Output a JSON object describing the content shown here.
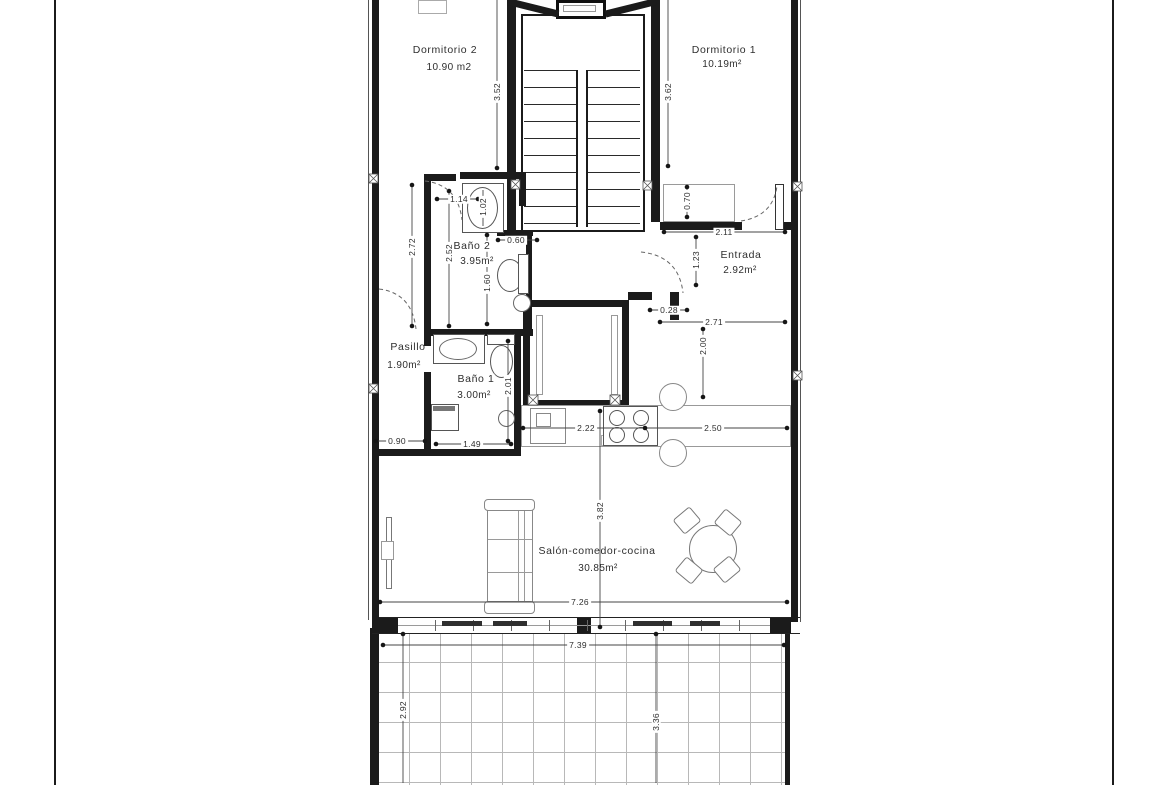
{
  "drawing": {
    "rooms": {
      "dormitorio2": {
        "name": "Dormitorio 2",
        "area": "10.90 m2"
      },
      "dormitorio1": {
        "name": "Dormitorio 1",
        "area": "10.19m²"
      },
      "banyo2": {
        "name": "Baño 2",
        "area": "3.95m²"
      },
      "entrada": {
        "name": "Entrada",
        "area": "2.92m²"
      },
      "pasillo": {
        "name": "Pasillo",
        "area": "1.90m²"
      },
      "banyo1": {
        "name": "Baño 1",
        "area": "3.00m²"
      },
      "salon": {
        "name": "Salón-comedor-cocina",
        "area": "30.85m²"
      }
    },
    "dimensions": {
      "dorm2_depth": "3.52",
      "dorm1_depth": "3.62",
      "banyo2_height": "2.72",
      "banyo2_inner": "2.52",
      "shower_width": "1.02",
      "dorm2_door": "1.14",
      "banyo2_niche": "0.60",
      "banyo2_width": "1.60",
      "entrada_closet": "0.70",
      "entrada_top": "2.11",
      "entrada_inner": "1.23",
      "wall_stub": "0.28",
      "entrada_width": "2.71",
      "entrada_depth": "2.00",
      "banyo1_depth": "2.01",
      "pasillo_width": "0.90",
      "banyo1_width": "1.49",
      "kitchen_left": "2.22",
      "kitchen_right": "2.50",
      "salon_depth": "3.82",
      "salon_width": "7.26",
      "terrace_width": "7.39",
      "terrace_left": "2.92",
      "terrace_right": "3.36"
    },
    "colors": {
      "wall": "#1b1b1b",
      "furniture": "#888888",
      "grid": "#b8b8b8",
      "text": "#2e2e2e"
    }
  }
}
